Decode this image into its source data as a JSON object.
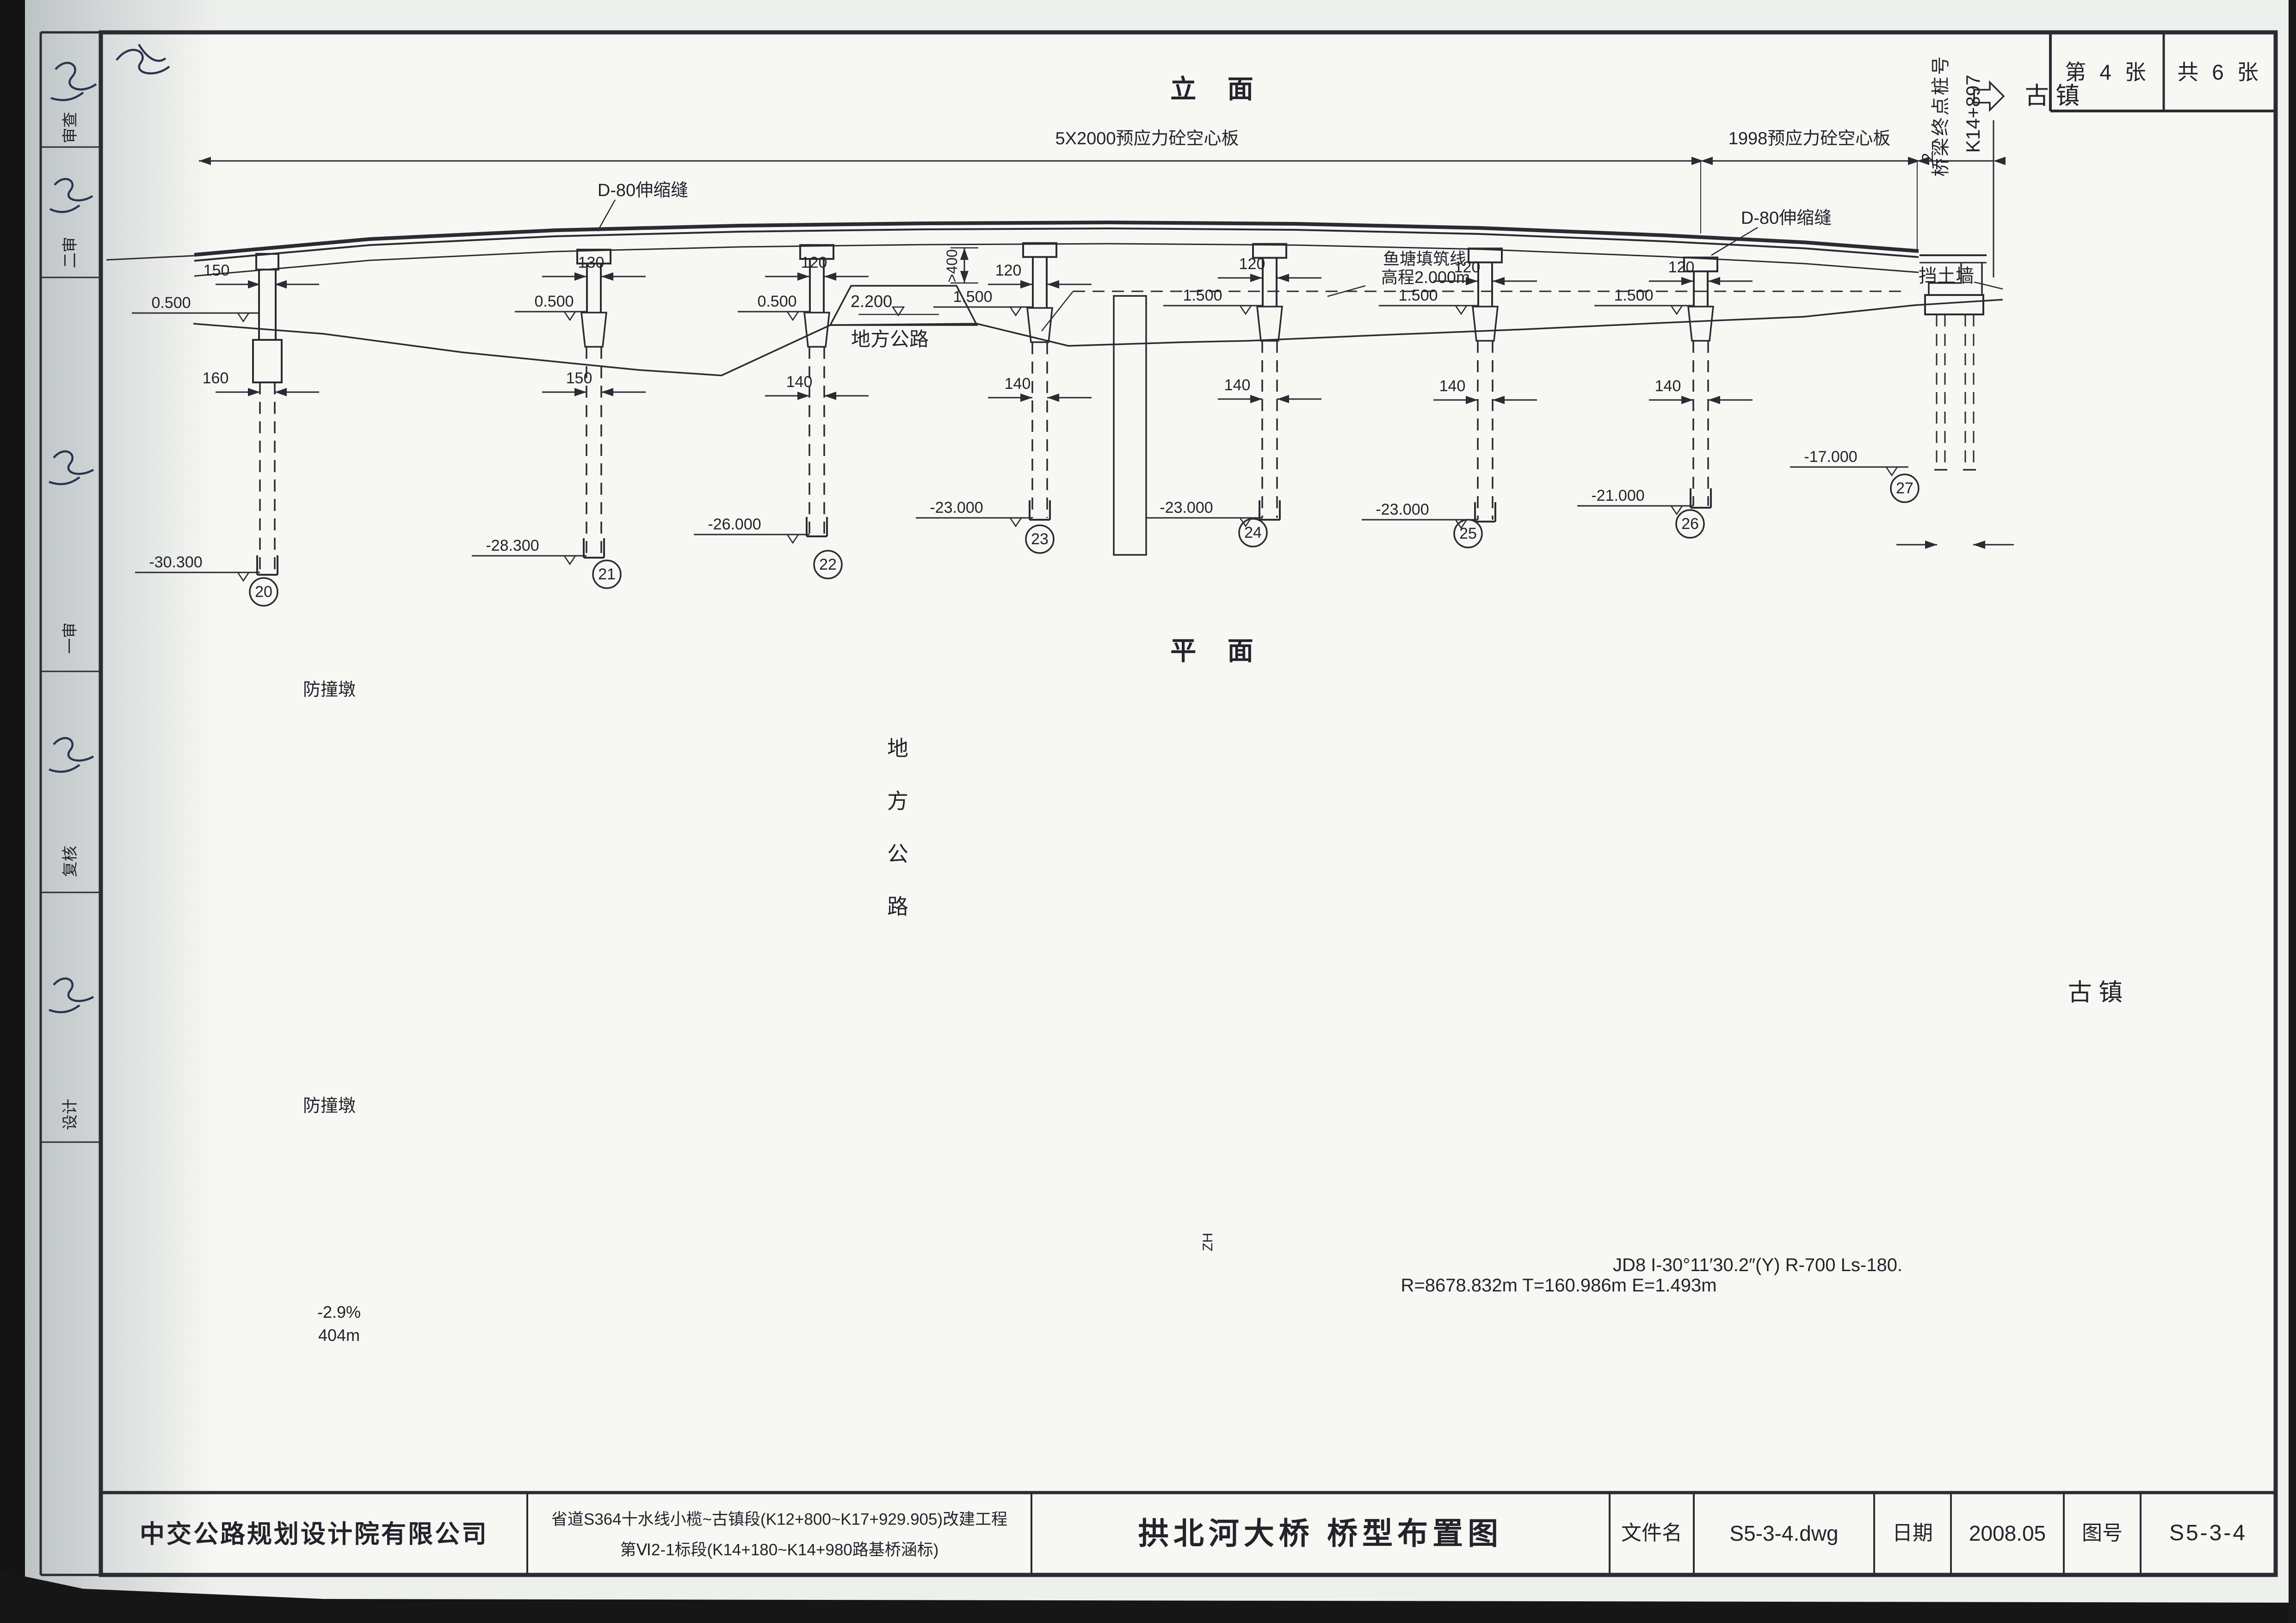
{
  "sheet": {
    "page_label": "第 4 张",
    "total_label": "共 6 张"
  },
  "endmark": {
    "label": "桥梁终点桩号",
    "station": "K14+897",
    "end_dim": "2"
  },
  "views": {
    "elevation": "立  面",
    "plan": "平  面"
  },
  "elevation": {
    "span_left": "5X2000预应力砼空心板",
    "span_right": "1998预应力砼空心板",
    "joint_left": "D-80伸缩缝",
    "joint_right": "D-80伸缩缝",
    "town": "古 镇",
    "wall": "挡土墙",
    "pond1": "鱼塘填筑线",
    "pond2": "高程2.000m",
    "road": "地方公路",
    "road_elev": "2.200",
    "road_clear": ">400",
    "piers": [
      {
        "no": "20",
        "width": "150",
        "cap_elev": "0.500",
        "pile_dim": "160",
        "base": "-30.300"
      },
      {
        "no": "21",
        "width": "130",
        "cap_elev": "0.500",
        "pile_dim": "150",
        "base": "-28.300"
      },
      {
        "no": "22",
        "width": "120",
        "cap_elev": "0.500",
        "pile_dim": "140",
        "base": "-26.000"
      },
      {
        "no": "23",
        "width": "120",
        "cap_elev": "1.500",
        "pile_dim": "140",
        "base": "-23.000"
      },
      {
        "no": "24",
        "width": "120",
        "cap_elev": "1.500",
        "pile_dim": "140",
        "base": "-23.000"
      },
      {
        "no": "25",
        "width": "120",
        "cap_elev": "1.500",
        "pile_dim": "140",
        "base": "-23.000"
      },
      {
        "no": "26",
        "width": "120",
        "cap_elev": "1.500",
        "pile_dim": "140",
        "base": "-21.000"
      },
      {
        "no": "27",
        "width": "120",
        "cap_elev": "",
        "pile_dim": "",
        "base": "-17.000"
      }
    ],
    "borehole_left": {
      "id": "2QZK14",
      "station": "K14+824",
      "layers": [
        {
          "elev": "2.49",
          "name": ""
        },
        {
          "elev": "0.59",
          "name": "耕土"
        },
        {
          "elev": "-7.71",
          "name": "粉砂"
        },
        {
          "elev": "-14.31",
          "name": "淤泥质土"
        },
        {
          "elev": "-15.81",
          "name": "亚粘土"
        },
        {
          "elev": "-16.71",
          "name": "全风化角砾岩"
        },
        {
          "elev": "-19.01",
          "name": "强风化角砾岩"
        },
        {
          "elev": "-30.51",
          "name": "弱风化角砾岩"
        }
      ]
    },
    "borehole_right": {
      "id": "2QZK15",
      "station": "K14+947",
      "layers": [
        {
          "elev": "3.20",
          "name": ""
        },
        {
          "elev": "2.10",
          "name": "素填土"
        },
        {
          "elev": "-0.70",
          "name": "耕土"
        },
        {
          "elev": "-3.50",
          "name": "粉砂"
        },
        {
          "elev": "-6.30",
          "name": "淤泥质土"
        },
        {
          "elev": "-9.60",
          "name": "全风化角砾岩"
        },
        {
          "elev": "-10.70",
          "name": "强风化角砾岩"
        },
        {
          "elev": "-29.20",
          "name": "弱风化角砾岩"
        }
      ]
    }
  },
  "plan": {
    "crash": "防撞墩",
    "d865": "865",
    "d1395": "1395",
    "d870": "870",
    "d1560": "1560",
    "d1604": "1604",
    "road": "地方公路",
    "town": "古 镇"
  },
  "pier_table": {
    "row1": [
      {
        "v": "9.26",
        "s": "+747.000"
      },
      {
        "v": "8.651",
        "s": "+777.000"
      },
      {
        "v": "8.186",
        "s": "+797.000"
      },
      {
        "v": "7.673",
        "s": "+817.000"
      },
      {
        "v": "7.112",
        "s": "+837.000"
      },
      {
        "v": "6.56",
        "s": "+857.000"
      },
      {
        "v": "6.054",
        "s": "+877.000"
      },
      {
        "v": "5.593",
        "s": "+897.001"
      }
    ],
    "row2": [
      {
        "v": "9.26",
        "s": "+747.000"
      },
      {
        "v": "8.651",
        "s": "+777.000"
      },
      {
        "v": "8.186",
        "s": "+797.000"
      },
      {
        "v": "7.673",
        "s": "+817.000"
      },
      {
        "v": "7.112",
        "s": "+837.000"
      },
      {
        "v": "6.56",
        "s": "+857.000"
      },
      {
        "v": "6.054",
        "s": "+877.000"
      },
      {
        "v": "5.593",
        "s": "+897.000"
      }
    ]
  },
  "alignment": {
    "zh": "ZH",
    "curve1": "JD8 I-30°11′30.2″(Y) R-700 Ls-180.",
    "curve2": "R=8678.832m T=160.986m E=1.493m",
    "grade": "-2.9%",
    "grade_len": "404m"
  },
  "profile": [
    {
      "v": "-4.5",
      "s": "+750.000"
    },
    {
      "v": "-3.23",
      "s": "+760.000"
    },
    {
      "v": "-1.85",
      "s": "+770.000"
    },
    {
      "v": "0.23",
      "s": "+775.200"
    },
    {
      "v": "2.09",
      "s": "+776.400"
    },
    {
      "v": "2.11",
      "s": "+777.000"
    },
    {
      "v": "0.11",
      "s": "+777.700"
    },
    {
      "v": "-0.67",
      "s": "+800.000"
    },
    {
      "v": "0.1",
      "s": "+813.000"
    },
    {
      "v": "1.9",
      "s": "+813.400"
    },
    {
      "v": "1.93",
      "s": "+820.000"
    },
    {
      "v": "-0.89",
      "s": "+820.800"
    },
    {
      "v": "-1.23",
      "s": "+840.000"
    },
    {
      "v": "-1.11",
      "s": "+860.000"
    },
    {
      "v": "-0.98",
      "s": "+880.000"
    },
    {
      "v": "-0.99",
      "s": "+893.400"
    },
    {
      "v": "1.84",
      "s": "+894.200"
    },
    {
      "v": "2.33",
      "s": "+900.000"
    },
    {
      "v": "3.96",
      "s": "+906.700"
    },
    {
      "v": "3.97",
      "s": "+910.000"
    }
  ],
  "margin": {
    "labels": [
      "审查",
      "二审",
      "一审",
      "复核",
      "设计"
    ]
  },
  "titleblock": {
    "company": "中交公路规划设计院有限公司",
    "project1": "省道S364十水线小榄~古镇段(K12+800~K17+929.905)改建工程",
    "project2": "第Ⅵ2-1标段(K14+180~K14+980路基桥涵标)",
    "title": "拱北河大桥 桥型布置图",
    "file_label": "文件名",
    "file": "S5-3-4.dwg",
    "date_label": "日期",
    "date": "2008.05",
    "no_label": "图号",
    "no": "S5-3-4"
  }
}
